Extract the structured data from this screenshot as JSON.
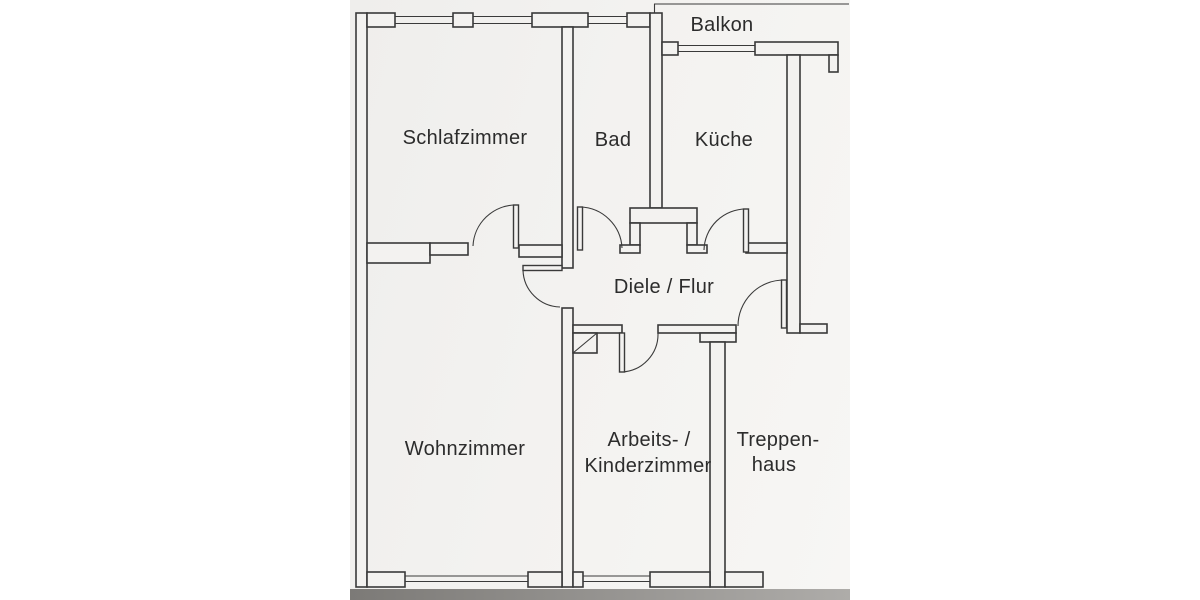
{
  "document": {
    "kind_note": "scanned apartment floor plan drawing"
  },
  "rooms": {
    "balkon": {
      "label": "Balkon"
    },
    "schlafzimmer": {
      "label": "Schlafzimmer"
    },
    "bad": {
      "label": "Bad"
    },
    "kueche": {
      "label": "Küche"
    },
    "diele": {
      "label": "Diele / Flur"
    },
    "wohnzimmer": {
      "label": "Wohnzimmer"
    },
    "arbeitszimmer": {
      "label_line1": "Arbeits- /",
      "label_line2": "Kinderzimmer"
    },
    "treppenhaus": {
      "label_line1": "Treppen-",
      "label_line2": "haus"
    }
  },
  "colors": {
    "background": "#ffffff",
    "paper": "#f3f2f0",
    "line": "#3a3a3a",
    "text": "#2c2c2c",
    "edge_dark": "#7c7a77",
    "edge_light": "#aeaca9"
  }
}
